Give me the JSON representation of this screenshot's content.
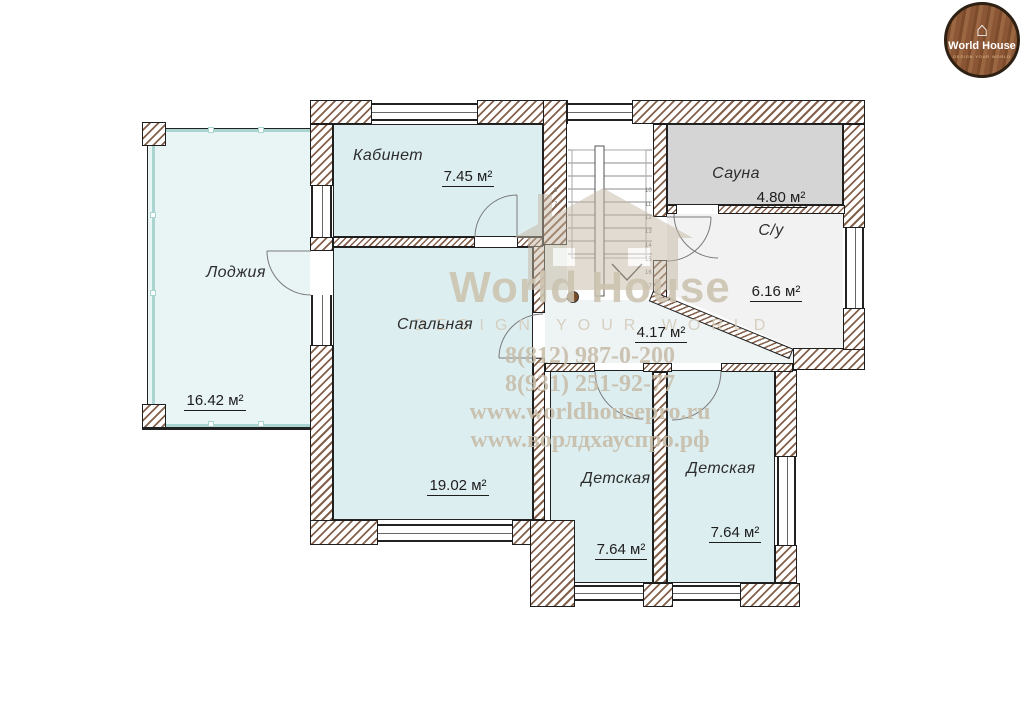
{
  "logo": {
    "brand": "World House",
    "tagline": "DESIGN YOUR WORLD"
  },
  "icons": {
    "house": "⌂"
  },
  "watermark": {
    "brand": "World House",
    "tagline": "DESIGN YOUR WORLD",
    "phones": [
      "8(812) 987-0-200",
      "8(931) 251-92-77"
    ],
    "sites": [
      "www.worldhousepro.ru",
      "www.ворлдхауспро.рф"
    ]
  },
  "rooms": {
    "loggia": {
      "name": "Лоджия",
      "area": "16.42 м²"
    },
    "office": {
      "name": "Кабинет",
      "area": "7.45 м²"
    },
    "bedroom": {
      "name": "Спальная",
      "area": "19.02 м²"
    },
    "sauna": {
      "name": "Сауна",
      "area": "4.80 м²"
    },
    "bathroom": {
      "name": "С/у",
      "area": "6.16 м²"
    },
    "hall": {
      "area": "4.17 м²"
    },
    "nursery1": {
      "name": "Детская",
      "area": "7.64 м²"
    },
    "nursery2": {
      "name": "Детская",
      "area": "7.64 м²"
    }
  },
  "stairs": {
    "left_step_numbers": [
      "8",
      "7"
    ],
    "right_step_numbers": [
      "10",
      "11",
      "12",
      "13",
      "14",
      "15",
      "16",
      "17"
    ]
  },
  "colors": {
    "room_fill": "#ddeef1",
    "loggia_fill": "#e9f4f5",
    "sauna_fill": "#d5d5d5",
    "bath_fill": "#f2f2f2",
    "hall_fill": "#eef3f4",
    "wall_hatch": "#85604a",
    "wall_outline": "#1d1d1d",
    "glazing": "#a9d4d0",
    "wm_title": "#ccc3b0",
    "wm_sub": "#d4cbba",
    "wm_text": "#c7bca8",
    "wm_house": "#c4b8a4",
    "logo_wood": "#8a5636"
  }
}
